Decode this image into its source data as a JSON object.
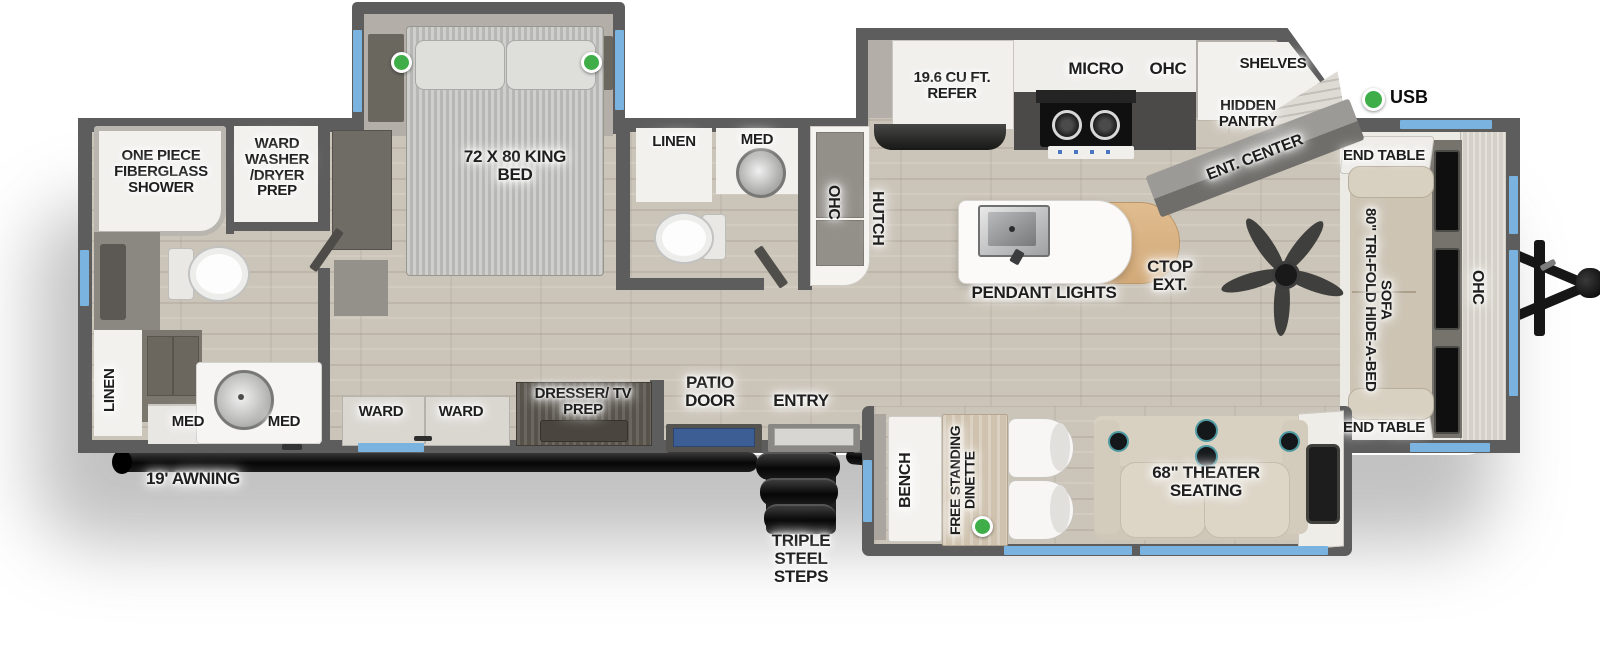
{
  "colors": {
    "wall": "#5d5d5d",
    "floor_wood": "#cbc4b8",
    "slide_interior": "#b3afa8",
    "window_blue": "#7ab3e0",
    "led_green": "#3fae49",
    "counter_dark": "#4b4a48",
    "island_wood": "#d9b183",
    "sofa_beige": "#cdc4b4",
    "label_ink": "#1e1e1e"
  },
  "plan": {
    "front_bath": {
      "shower": "ONE PIECE FIBERGLASS SHOWER",
      "ward_washer": "WARD WASHER /DRYER PREP",
      "linen": "LINEN",
      "med_left": "MED",
      "med_right": "MED"
    },
    "bedroom": {
      "king_bed": "72 X 80 KING BED",
      "ward_a": "WARD",
      "ward_b": "WARD",
      "dresser": "DRESSER/ TV PREP"
    },
    "mid_bath": {
      "linen": "LINEN",
      "med": "MED"
    },
    "kitchen": {
      "refer": "19.6 CU FT. REFER",
      "micro": "MICRO",
      "ohc": "OHC",
      "shelves": "SHELVES",
      "hidden_pantry": "HIDDEN PANTRY",
      "ent_center": "ENT. CENTER",
      "hutch_ohc": "OHC",
      "hutch": "HUTCH",
      "pendant_lights": "PENDANT LIGHTS",
      "ctop_ext": "CTOP EXT."
    },
    "living": {
      "sofa": "80\" TRI-FOLD HIDE-A-BED SOFA",
      "end_table_top": "END TABLE",
      "end_table_bottom": "END TABLE",
      "front_ohc": "OHC",
      "usb": "USB"
    },
    "dinette_slide": {
      "bench": "BENCH",
      "dinette": "FREE STANDING DINETTE",
      "theater": "68\" THEATER SEATING"
    },
    "doors": {
      "patio": "PATIO DOOR",
      "entry": "ENTRY"
    },
    "exterior": {
      "awning": "19' AWNING",
      "steps": "TRIPLE STEEL STEPS"
    }
  }
}
